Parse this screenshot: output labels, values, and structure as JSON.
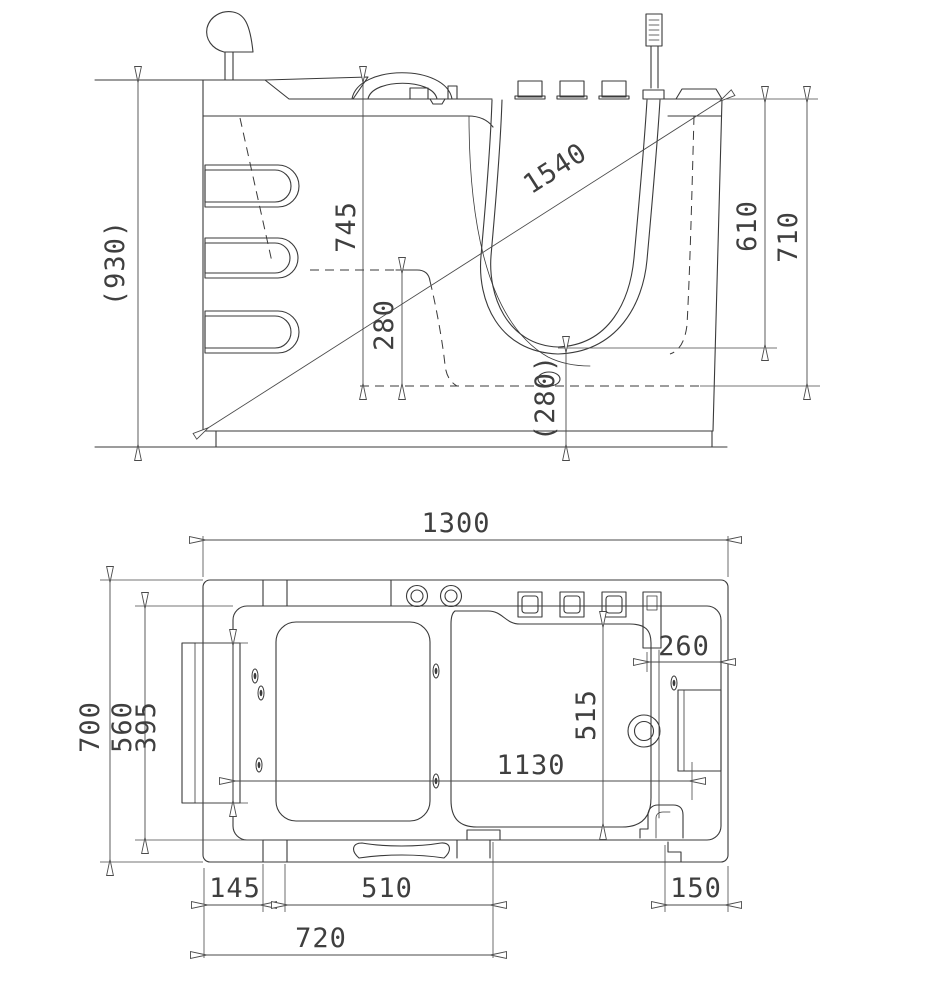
{
  "document": {
    "type": "walk-in bathtub technical drawing",
    "background_color": "#ffffff",
    "line_color": "#3a3a3a",
    "views": [
      "side elevation",
      "plan (top) view"
    ]
  },
  "dimensions": {
    "side": {
      "overall_height": "(930)",
      "rim_to_floor": "745",
      "backrest_depth": "280",
      "diagonal": "1540",
      "seat_height": "(280)",
      "rim_to_seat": "610",
      "rim_to_interior_floor": "710"
    },
    "plan": {
      "overall_length": "1300",
      "overall_width": "700",
      "basin_width": "560",
      "door_opening": "395",
      "seat_width": "515",
      "end_deck_width": "260",
      "interior_length": "1130",
      "skirt_left_offset": "145",
      "skirt_panel_width": "510",
      "skirt_right_offset": "150",
      "front_panel_length": "720"
    }
  }
}
